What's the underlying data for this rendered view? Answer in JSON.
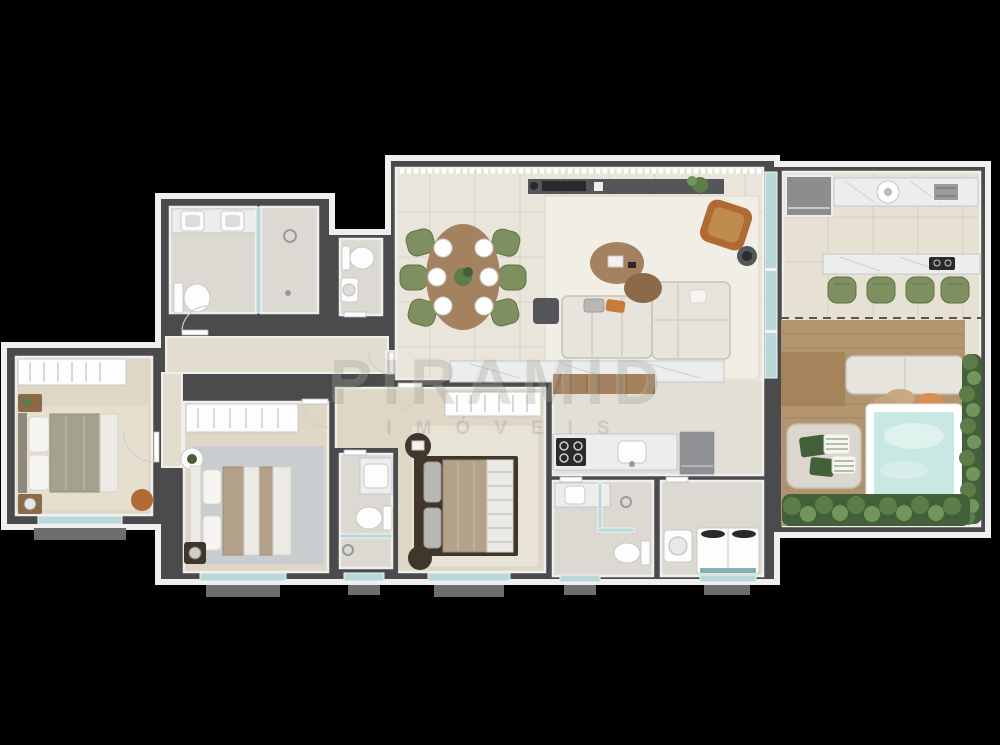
{
  "watermark": {
    "title": "PIRAMID",
    "subtitle": "IMÓVEIS"
  },
  "palette": {
    "bg": "#000000",
    "wall": "#4b4b4d",
    "trim": "#efefed",
    "floorLiving": "#e9e5da",
    "floorBedroom": "#ded7c6",
    "floorTile": "#dcd9d2",
    "floorKitchen": "#e3dfd4",
    "floorTerrace": "#e6e1d3",
    "floorHall": "#e3ddcf",
    "deck": "#b2946f",
    "deckDark": "#a5845c",
    "marble": "#eceded",
    "wood": "#a5825f",
    "woodDark": "#8b6a4a",
    "sofa": "#e7e4dd",
    "rug": "#f1eee5",
    "olive": "#7e9060",
    "green": "#5c7c48",
    "greenDark": "#44603a",
    "water": "#c9e7e3",
    "glass": "#b9d8da",
    "appliance": "#8f9093",
    "console": "#55565a",
    "tan": "#c08b4f",
    "orange": "#c87c3a",
    "bedSage": "#a3a28f",
    "bedTan": "#b3a189",
    "sill": "#6e6e70"
  },
  "rooms": [
    {
      "name": "suite-bathroom",
      "furniture": [
        "double-sink-vanity",
        "toilet",
        "glass-shower"
      ]
    },
    {
      "name": "guest-wc",
      "furniture": [
        "toilet",
        "washbasin"
      ]
    },
    {
      "name": "bedroom-left",
      "furniture": [
        "wardrobe",
        "double-bed",
        "nightstands",
        "pouf"
      ]
    },
    {
      "name": "bedroom-middle",
      "furniture": [
        "wardrobe",
        "double-bed",
        "side-table",
        "rug"
      ]
    },
    {
      "name": "master-bedroom",
      "furniture": [
        "wardrobe",
        "double-bed",
        "nightstand",
        "rug"
      ]
    },
    {
      "name": "master-ensuite",
      "furniture": [
        "vanity",
        "toilet",
        "glass-shower"
      ]
    },
    {
      "name": "living-dining",
      "furniture": [
        "dining-table",
        "six-chairs",
        "sofa",
        "chaise-sofa",
        "coffee-tables",
        "armchair",
        "tv-console",
        "rug"
      ]
    },
    {
      "name": "kitchen",
      "furniture": [
        "island-counter",
        "cooktop",
        "sink",
        "refrigerator"
      ]
    },
    {
      "name": "service-bathroom",
      "furniture": [
        "vanity",
        "glass-shower",
        "toilet"
      ]
    },
    {
      "name": "laundry",
      "furniture": [
        "utility-sink",
        "washer-dryer"
      ]
    },
    {
      "name": "gourmet-terrace",
      "furniture": [
        "counter-with-sink",
        "built-in-grill",
        "bar-counter",
        "four-stools",
        "wood-deck",
        "daybed",
        "lounge-bench",
        "plunge-pool",
        "planters"
      ]
    }
  ]
}
